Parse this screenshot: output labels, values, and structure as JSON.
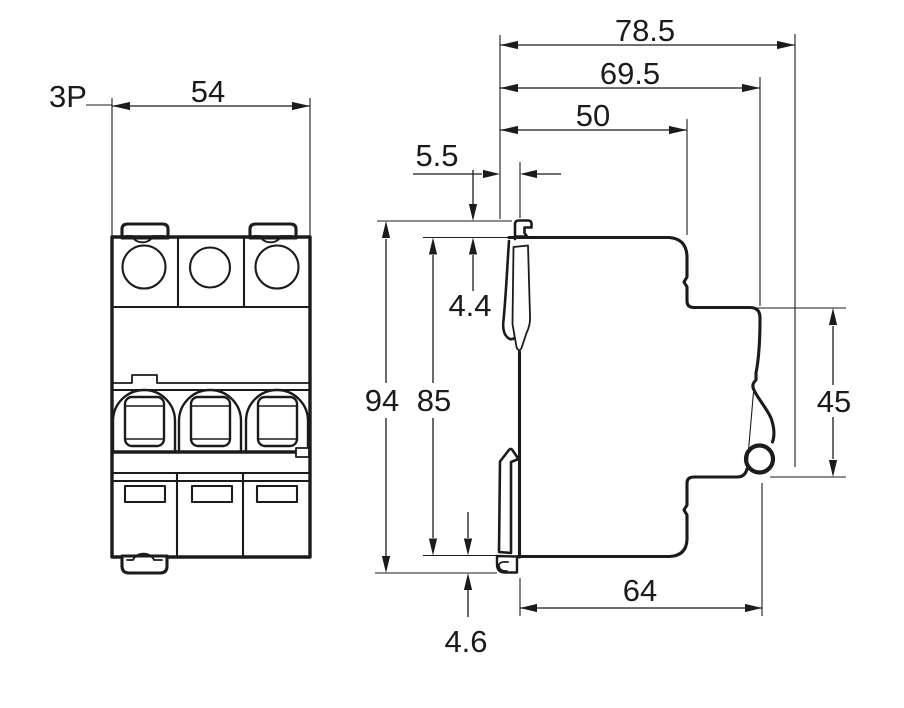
{
  "labels": {
    "pole": "3P",
    "front_width": "54",
    "overall_depth": "78.5",
    "depth_without_clips": "69.5",
    "upper_depth": "50",
    "clip_offset": "5.5",
    "top_clip_protrusion": "4.4",
    "overall_height": "94",
    "body_height": "85",
    "front_face_height": "45",
    "lower_depth": "64",
    "bottom_clip_protrusion": "4.6"
  },
  "colors": {
    "line": "#1b1b1b",
    "background": "#ffffff"
  }
}
